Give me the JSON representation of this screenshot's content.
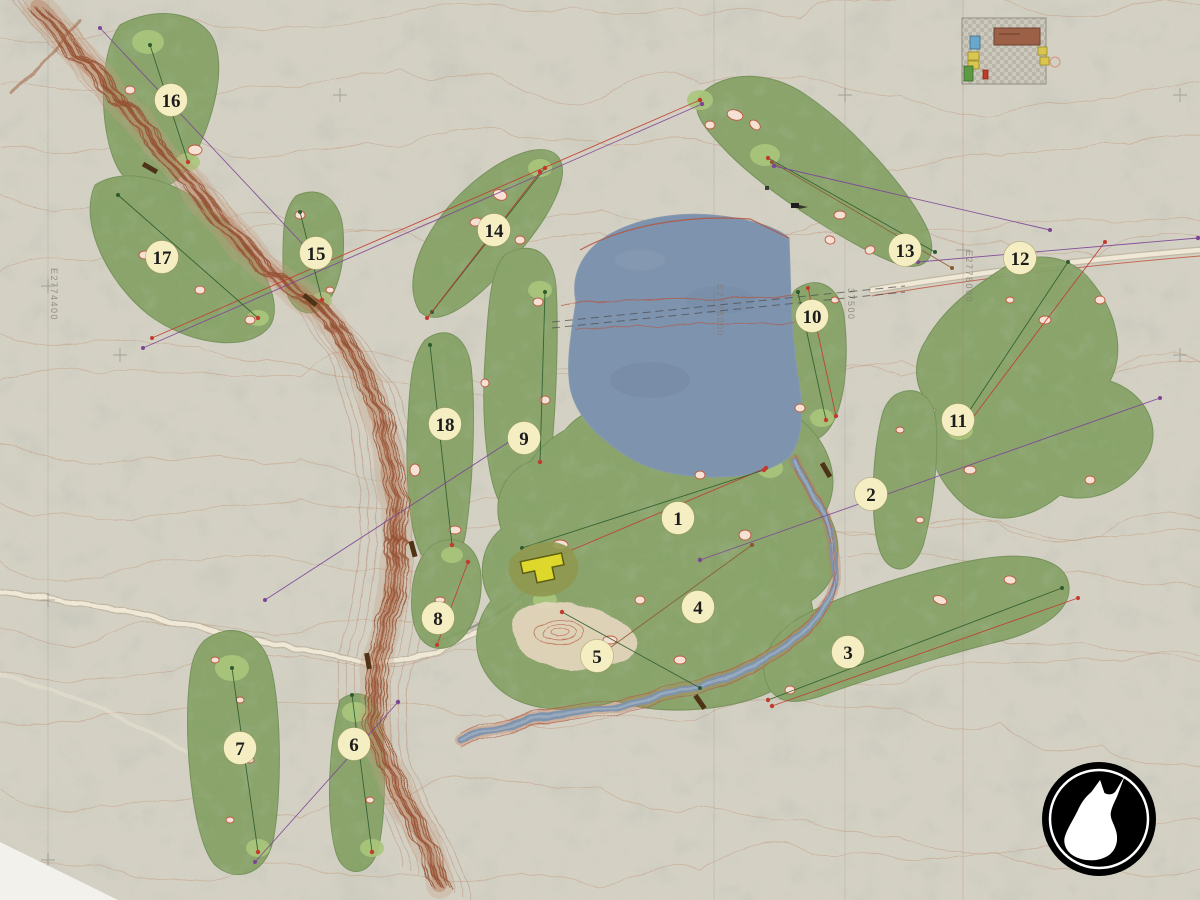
{
  "map": {
    "type": "golf-course-master-plan",
    "holes": [
      {
        "n": "1",
        "x": 678,
        "y": 518
      },
      {
        "n": "2",
        "x": 871,
        "y": 494
      },
      {
        "n": "3",
        "x": 848,
        "y": 652
      },
      {
        "n": "4",
        "x": 698,
        "y": 607
      },
      {
        "n": "5",
        "x": 597,
        "y": 656
      },
      {
        "n": "6",
        "x": 354,
        "y": 744
      },
      {
        "n": "7",
        "x": 240,
        "y": 748
      },
      {
        "n": "8",
        "x": 438,
        "y": 618
      },
      {
        "n": "9",
        "x": 524,
        "y": 438
      },
      {
        "n": "10",
        "x": 812,
        "y": 316
      },
      {
        "n": "11",
        "x": 958,
        "y": 420
      },
      {
        "n": "12",
        "x": 1020,
        "y": 258
      },
      {
        "n": "13",
        "x": 905,
        "y": 250
      },
      {
        "n": "14",
        "x": 494,
        "y": 230
      },
      {
        "n": "15",
        "x": 316,
        "y": 253
      },
      {
        "n": "16",
        "x": 171,
        "y": 100
      },
      {
        "n": "17",
        "x": 162,
        "y": 257
      },
      {
        "n": "18",
        "x": 445,
        "y": 424
      }
    ],
    "grid_labels": [
      {
        "text": "E2774400",
        "x": 48,
        "y": 268
      },
      {
        "text": "E2776000",
        "x": 714,
        "y": 284
      },
      {
        "text": "37500",
        "x": 845,
        "y": 288
      },
      {
        "text": "E2778000",
        "x": 963,
        "y": 250
      }
    ],
    "colors": {
      "background": "#d6d3c6",
      "fairway": "#84a164",
      "green_light": "#aac77c",
      "lake": "#7e93ae",
      "bunker_sand": "#f6e2d4",
      "bunker_outline": "#bf5740",
      "canyon": "#8f4a2c",
      "contour": "#bd8766",
      "hole_badge": "#f4eec2",
      "hole_number": "#1c1c1c",
      "line_red": "#c23b2e",
      "line_purple": "#7d4596",
      "line_green": "#2e5b2e",
      "line_brown": "#8a5a30",
      "logo_bg": "#000000",
      "logo_fg": "#ffffff",
      "legend_brown": "#9c6047",
      "legend_blue": "#69a8cc",
      "legend_yellow": "#d9c64f",
      "legend_green": "#5c9a44",
      "legend_red": "#c23a28"
    }
  }
}
